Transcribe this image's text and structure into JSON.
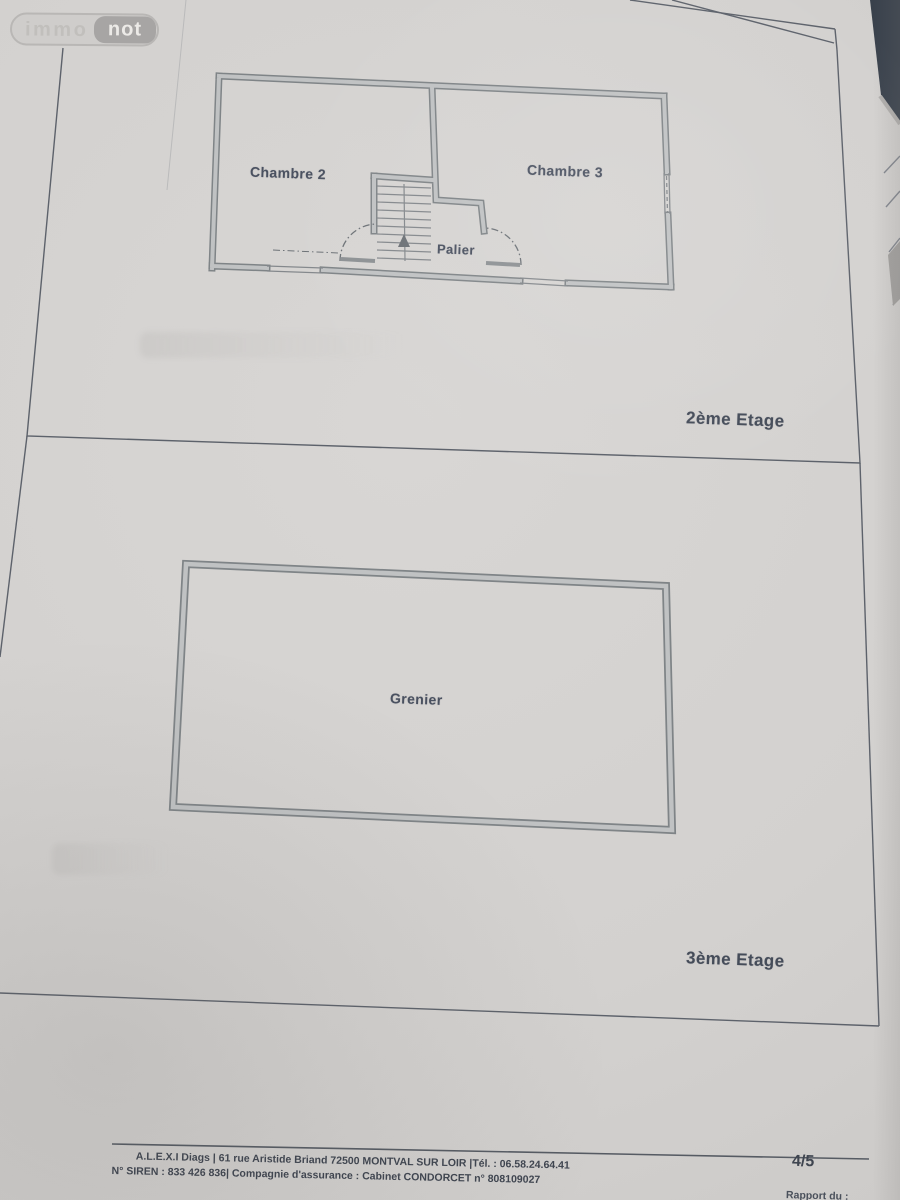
{
  "colors": {
    "paper": "#d5d3d1",
    "background_dark": "#39414c",
    "wall_edge": "#7f8487",
    "wall_core": "#c0c2c3",
    "panel_line": "#5d626b",
    "label_text": "#4a5160",
    "footer_text": "#3f4550"
  },
  "logo": {
    "immo": "immo",
    "not": "not"
  },
  "plans": [
    {
      "floor_label": "2ème Etage",
      "rooms": {
        "room1": "Chambre 2",
        "room2": "Chambre 3",
        "landing": "Palier"
      }
    },
    {
      "floor_label": "3ème Etage",
      "rooms": {
        "attic": "Grenier"
      }
    }
  ],
  "footer": {
    "company_line": "A.L.E.X.I Diags | 61 rue Aristide Briand 72500 MONTVAL SUR LOIR |Tél. : 06.58.24.64.41",
    "siren_line": "N° SIREN : 833 426 836| Compagnie d'assurance : Cabinet CONDORCET n° 808109027",
    "page_number": "4/5",
    "report_date_label": "Rapport du :"
  }
}
